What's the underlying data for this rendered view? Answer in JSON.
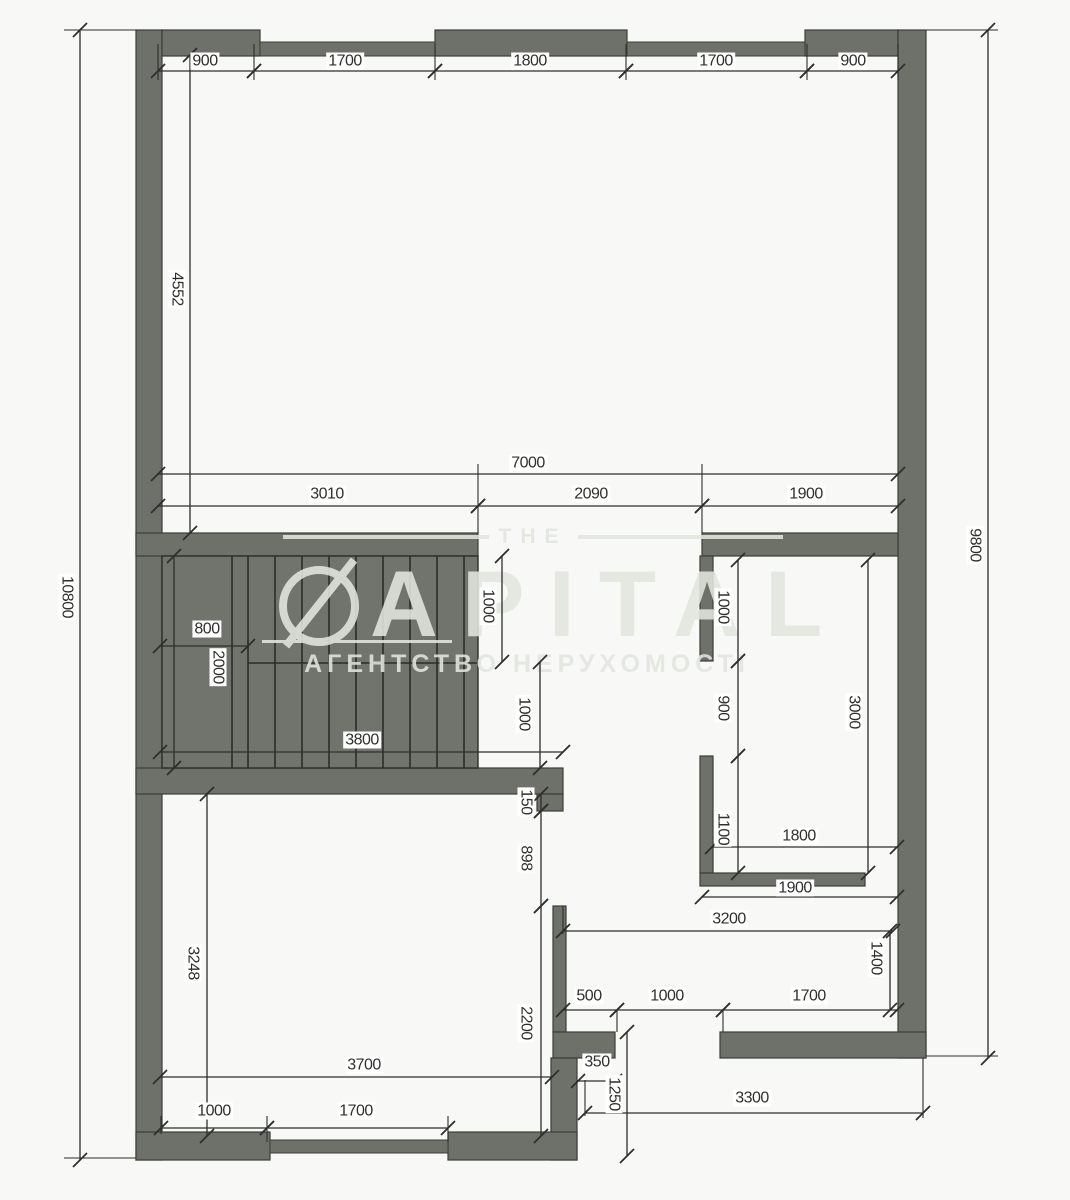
{
  "meta": {
    "type": "architectural-floor-plan",
    "units": "mm"
  },
  "watermark": {
    "top_word": "THE",
    "brand_rest": "APITAL",
    "logo": "crossed-circle-icon",
    "subtitle": "АГЕНТСТВО НЕРУХОМОСТІ"
  },
  "plan": {
    "canvas": {
      "width": 1070,
      "height": 1200,
      "background": "#f8f8f6"
    },
    "colors": {
      "wall_fill": "#6d716a",
      "wall_stroke": "#3b3e37",
      "stair_fill": "#70746c",
      "stair_tread": "#2b2d28",
      "dim_line": "#2e2e2c",
      "dim_text": "#2f2f2d",
      "dim_text_bg": "#ffffff",
      "watermark": "#e3e5df"
    },
    "walls": [
      [
        136,
        30,
        26,
        1130
      ],
      [
        162,
        30,
        98,
        26
      ],
      [
        435,
        30,
        192,
        26
      ],
      [
        805,
        30,
        93,
        26
      ],
      [
        898,
        30,
        28,
        1028
      ],
      [
        136,
        533,
        342,
        23
      ],
      [
        702,
        533,
        196,
        23
      ],
      [
        700,
        556,
        13,
        105
      ],
      [
        700,
        756,
        13,
        117
      ],
      [
        700,
        873,
        165,
        13
      ],
      [
        136,
        768,
        427,
        26
      ],
      [
        537,
        794,
        26,
        17
      ],
      [
        553,
        906,
        13,
        126
      ],
      [
        553,
        1032,
        62,
        26
      ],
      [
        551,
        1058,
        26,
        102
      ],
      [
        136,
        1132,
        134,
        28
      ],
      [
        448,
        1132,
        129,
        28
      ],
      [
        720,
        1032,
        206,
        26
      ]
    ],
    "windows": [
      [
        260,
        42,
        175,
        14
      ],
      [
        627,
        42,
        178,
        14
      ],
      [
        270,
        1140,
        178,
        13
      ]
    ],
    "stairs": {
      "area": [
        162,
        556,
        316,
        212
      ],
      "tread_xs": [
        232,
        248,
        275,
        302,
        329,
        356,
        383,
        410,
        437,
        464
      ],
      "divider_y": 663,
      "divider_x1": 248,
      "divider_x2": 478
    },
    "extension_lines": [
      [
        158,
        44,
        158,
        80
      ],
      [
        254,
        44,
        254,
        80
      ],
      [
        435,
        44,
        435,
        80
      ],
      [
        626,
        44,
        626,
        80
      ],
      [
        807,
        44,
        807,
        80
      ],
      [
        898,
        44,
        898,
        80
      ],
      [
        64,
        30,
        136,
        30
      ],
      [
        64,
        1158,
        136,
        1158
      ],
      [
        926,
        30,
        998,
        30
      ],
      [
        926,
        1056,
        998,
        1056
      ],
      [
        478,
        464,
        478,
        533
      ],
      [
        702,
        464,
        702,
        533
      ],
      [
        563,
        906,
        563,
        934
      ],
      [
        585,
        1080,
        585,
        1116
      ],
      [
        923,
        1058,
        923,
        1118
      ],
      [
        161,
        1116,
        161,
        1134
      ],
      [
        267,
        1116,
        267,
        1142
      ],
      [
        448,
        1116,
        448,
        1142
      ],
      [
        617,
        1010,
        617,
        1032
      ],
      [
        723,
        1010,
        723,
        1032
      ]
    ],
    "dimensions": [
      {
        "label": "900",
        "orient": "h",
        "a": 158,
        "b": 254,
        "pos": 71,
        "lx": 205,
        "ly": 61
      },
      {
        "label": "1700",
        "orient": "h",
        "a": 254,
        "b": 435,
        "pos": 71,
        "lx": 345,
        "ly": 61
      },
      {
        "label": "1800",
        "orient": "h",
        "a": 435,
        "b": 626,
        "pos": 71,
        "lx": 530,
        "ly": 61
      },
      {
        "label": "1700",
        "orient": "h",
        "a": 626,
        "b": 807,
        "pos": 71,
        "lx": 716,
        "ly": 61
      },
      {
        "label": "900",
        "orient": "h",
        "a": 807,
        "b": 898,
        "pos": 71,
        "lx": 853,
        "ly": 61
      },
      {
        "label": "10800",
        "orient": "v",
        "a": 30,
        "b": 1160,
        "pos": 80,
        "lx": 67,
        "ly": 597
      },
      {
        "label": "4552",
        "orient": "v",
        "a": 55,
        "b": 533,
        "pos": 190,
        "lx": 177,
        "ly": 289
      },
      {
        "label": "9800",
        "orient": "v",
        "a": 30,
        "b": 1058,
        "pos": 988,
        "lx": 975,
        "ly": 545
      },
      {
        "label": "7000",
        "orient": "h",
        "a": 158,
        "b": 898,
        "pos": 474,
        "lx": 528,
        "ly": 463
      },
      {
        "label": "3010",
        "orient": "h",
        "a": 158,
        "b": 478,
        "pos": 506,
        "lx": 327,
        "ly": 494
      },
      {
        "label": "2090",
        "orient": "h",
        "a": 478,
        "b": 702,
        "pos": 506,
        "lx": 591,
        "ly": 494
      },
      {
        "label": "1900",
        "orient": "h",
        "a": 702,
        "b": 898,
        "pos": 506,
        "lx": 806,
        "ly": 494
      },
      {
        "label": "800",
        "orient": "h",
        "a": 160,
        "b": 248,
        "pos": 646,
        "lx": 207,
        "ly": 629
      },
      {
        "label": "2000",
        "orient": "v",
        "a": 556,
        "b": 768,
        "pos": 174,
        "lx": 218,
        "ly": 667
      },
      {
        "label": "3800",
        "orient": "h",
        "a": 160,
        "b": 563,
        "pos": 752,
        "lx": 362,
        "ly": 740
      },
      {
        "label": "1000",
        "orient": "v",
        "a": 556,
        "b": 662,
        "pos": 502,
        "lx": 488,
        "ly": 606
      },
      {
        "label": "1000",
        "orient": "v",
        "a": 662,
        "b": 768,
        "pos": 540,
        "lx": 524,
        "ly": 714
      },
      {
        "label": "150",
        "orient": "v",
        "a": 794,
        "b": 811,
        "pos": 541,
        "lx": 526,
        "ly": 802
      },
      {
        "label": "898",
        "orient": "v",
        "a": 811,
        "b": 906,
        "pos": 541,
        "lx": 526,
        "ly": 858
      },
      {
        "label": "2200",
        "orient": "v",
        "a": 906,
        "b": 1136,
        "pos": 541,
        "lx": 526,
        "ly": 1023
      },
      {
        "label": "3248",
        "orient": "v",
        "a": 794,
        "b": 1136,
        "pos": 207,
        "lx": 193,
        "ly": 963
      },
      {
        "label": "3700",
        "orient": "h",
        "a": 160,
        "b": 552,
        "pos": 1077,
        "lx": 364,
        "ly": 1065
      },
      {
        "label": "1000",
        "orient": "h",
        "a": 161,
        "b": 267,
        "pos": 1128,
        "lx": 214,
        "ly": 1111
      },
      {
        "label": "1700",
        "orient": "h",
        "a": 267,
        "b": 448,
        "pos": 1128,
        "lx": 356,
        "ly": 1111
      },
      {
        "label": "1000",
        "orient": "v",
        "a": 560,
        "b": 661,
        "pos": 738,
        "lx": 723,
        "ly": 607
      },
      {
        "label": "900",
        "orient": "v",
        "a": 661,
        "b": 756,
        "pos": 738,
        "lx": 723,
        "ly": 708
      },
      {
        "label": "1100",
        "orient": "v",
        "a": 756,
        "b": 873,
        "pos": 738,
        "lx": 723,
        "ly": 829
      },
      {
        "label": "3000",
        "orient": "v",
        "a": 560,
        "b": 873,
        "pos": 868,
        "lx": 854,
        "ly": 712
      },
      {
        "label": "1800",
        "orient": "h",
        "a": 712,
        "b": 897,
        "pos": 847,
        "lx": 799,
        "ly": 836
      },
      {
        "label": "1900",
        "orient": "h",
        "a": 702,
        "b": 897,
        "pos": 897,
        "lx": 795,
        "ly": 888
      },
      {
        "label": "3200",
        "orient": "h",
        "a": 563,
        "b": 893,
        "pos": 931,
        "lx": 729,
        "ly": 919
      },
      {
        "label": "1400",
        "orient": "v",
        "a": 931,
        "b": 1010,
        "pos": 890,
        "lx": 876,
        "ly": 958
      },
      {
        "label": "500",
        "orient": "h",
        "a": 563,
        "b": 617,
        "pos": 1010,
        "lx": 589,
        "ly": 996
      },
      {
        "label": "1000",
        "orient": "h",
        "a": 617,
        "b": 723,
        "pos": 1010,
        "lx": 667,
        "ly": 996
      },
      {
        "label": "1700",
        "orient": "h",
        "a": 723,
        "b": 897,
        "pos": 1010,
        "lx": 809,
        "ly": 996
      },
      {
        "label": "350",
        "orient": "h",
        "a": 578,
        "b": 615,
        "pos": 1081,
        "lx": 597,
        "ly": 1062
      },
      {
        "label": "1250",
        "orient": "v",
        "a": 1032,
        "b": 1156,
        "pos": 627,
        "lx": 614,
        "ly": 1094
      },
      {
        "label": "3300",
        "orient": "h",
        "a": 585,
        "b": 923,
        "pos": 1113,
        "lx": 752,
        "ly": 1098
      }
    ]
  }
}
